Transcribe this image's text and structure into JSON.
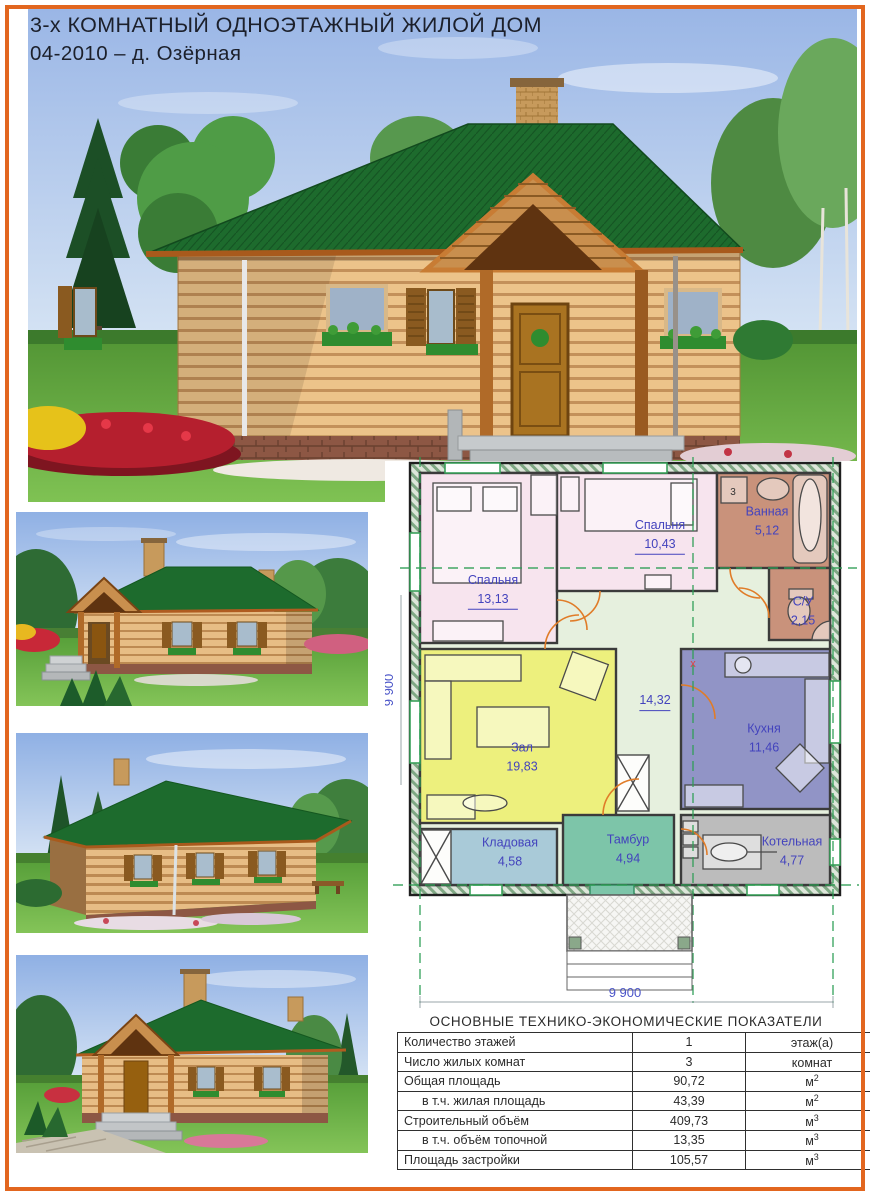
{
  "page": {
    "title_line1": "3-х КОМНАТНЫЙ ОДНОЭТАЖНЫЙ ЖИЛОЙ ДОМ",
    "title_line2": "04-2010 – д. Озёрная",
    "border_color": "#e2661f"
  },
  "plan": {
    "rooms": [
      {
        "name": "Спальня",
        "area": "13,13"
      },
      {
        "name": "Спальня",
        "area": "10,43"
      },
      {
        "name": "Ванная",
        "area": "5,12"
      },
      {
        "name": "С/У",
        "area": "2,15"
      },
      {
        "name": "",
        "area": "14,32"
      },
      {
        "name": "Зал",
        "area": "19,83"
      },
      {
        "name": "Кухня",
        "area": "11,46"
      },
      {
        "name": "Кладовая",
        "area": "4,58"
      },
      {
        "name": "Тамбур",
        "area": "4,94"
      },
      {
        "name": "Котельная",
        "area": "4,77"
      }
    ],
    "dim_bottom": "9 900",
    "dim_left": "9 900",
    "marker_washer": "3",
    "marker_stove": "х",
    "label_color": "#4343bd",
    "axis_color": "#2e9e55"
  },
  "table": {
    "title": "ОСНОВНЫЕ ТЕХНИКО-ЭКОНОМИЧЕСКИЕ ПОКАЗАТЕЛИ",
    "rows": [
      {
        "label": "Количество этажей",
        "value": "1",
        "unit": "этаж(а)",
        "sup": ""
      },
      {
        "label": "Число жилых комнат",
        "value": "3",
        "unit": "комнат",
        "sup": ""
      },
      {
        "label": "Общая площадь",
        "value": "90,72",
        "unit": "м",
        "sup": "2"
      },
      {
        "label": "в т.ч. жилая площадь",
        "value": "43,39",
        "unit": "м",
        "sup": "2"
      },
      {
        "label": "Строительный объём",
        "value": "409,73",
        "unit": "м",
        "sup": "3"
      },
      {
        "label": "в т.ч. объём топочной",
        "value": "13,35",
        "unit": "м",
        "sup": "3"
      },
      {
        "label": "Площадь застройки",
        "value": "105,57",
        "unit": "м",
        "sup": "3"
      }
    ]
  }
}
